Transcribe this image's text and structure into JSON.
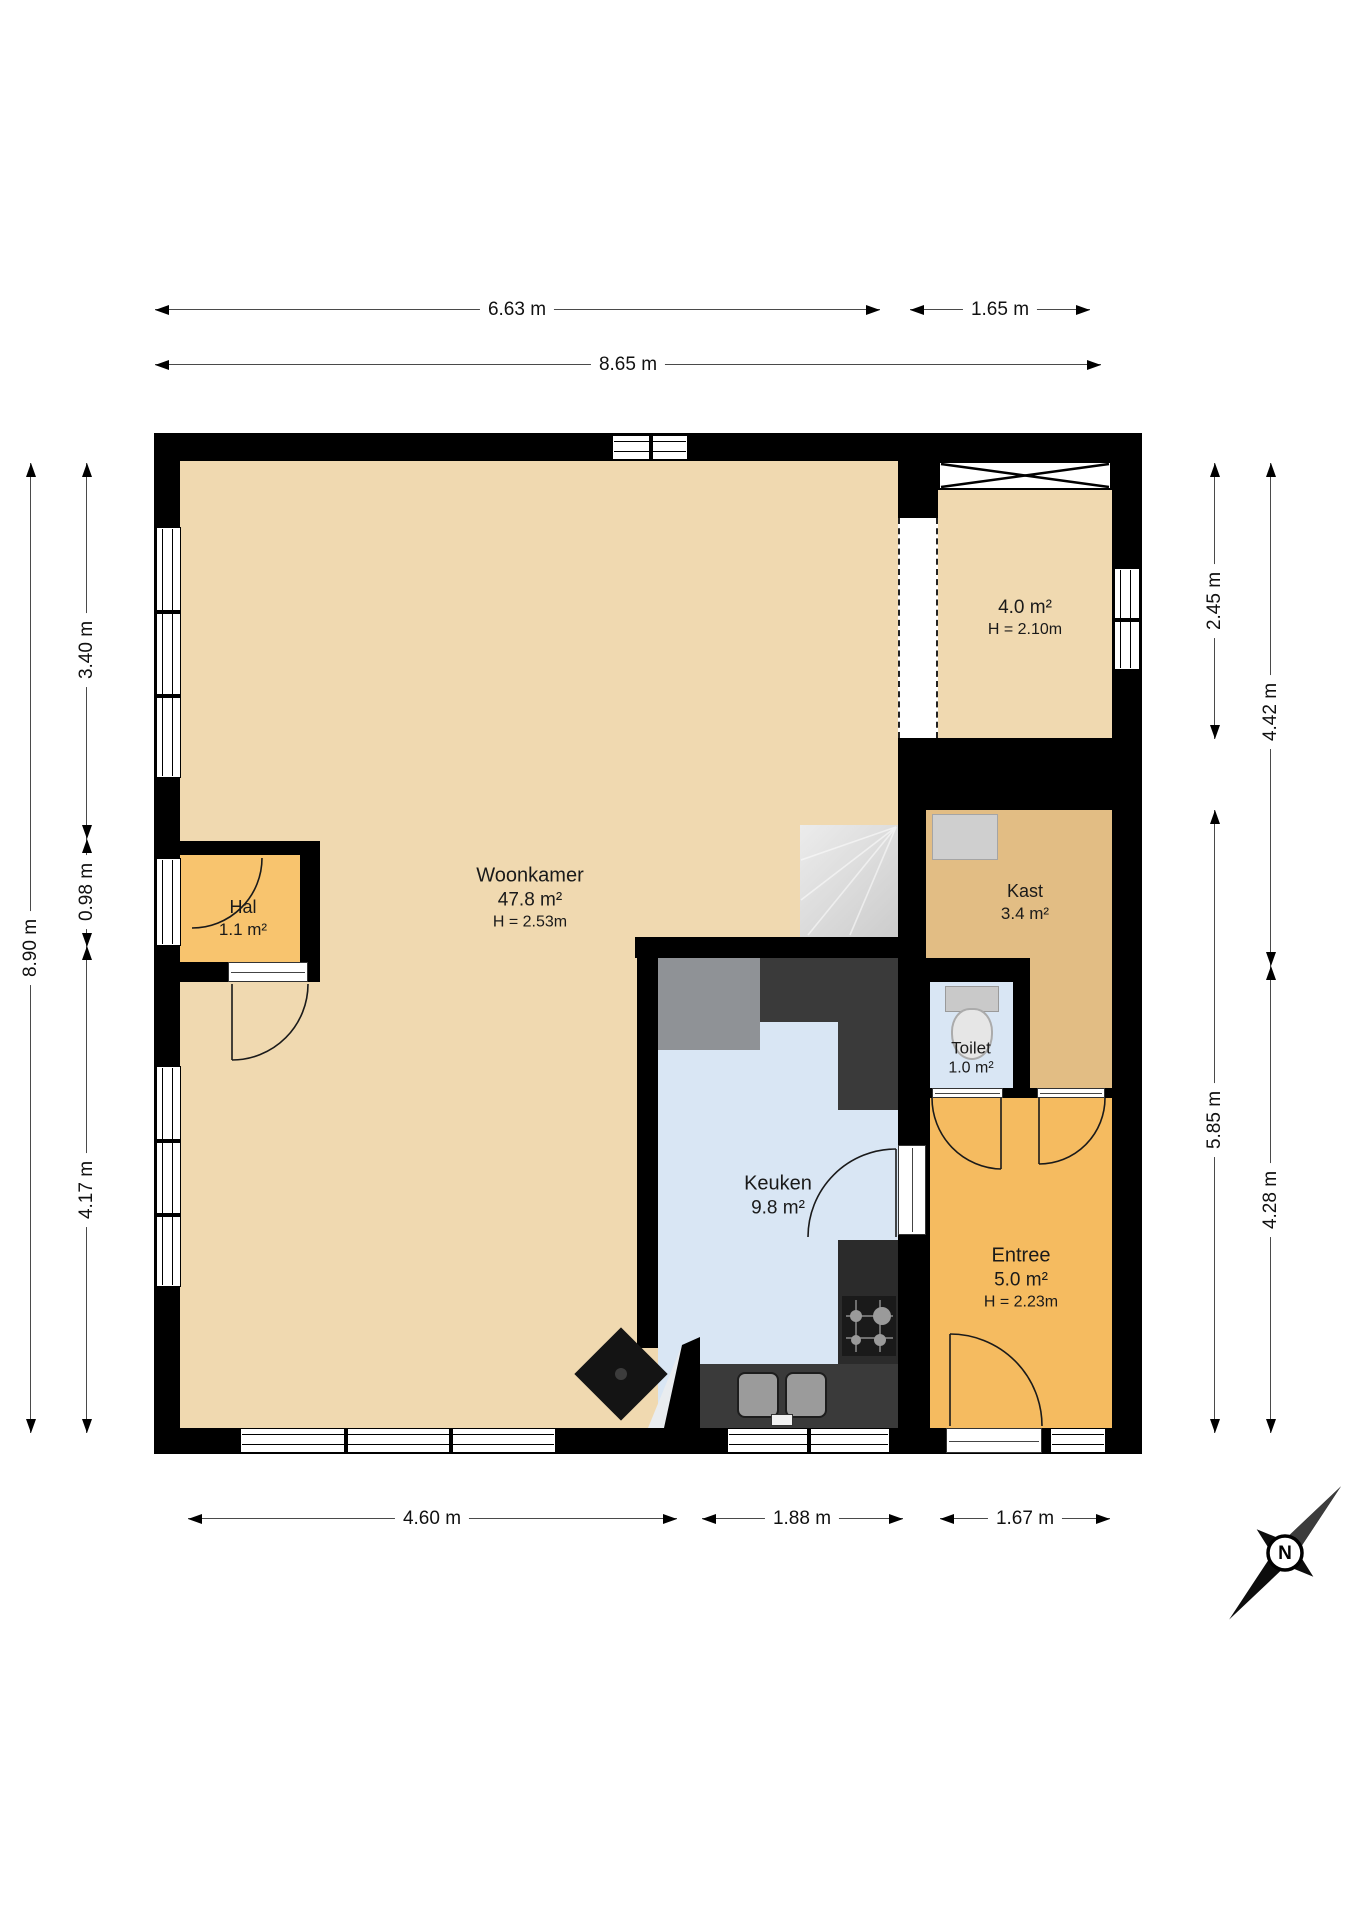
{
  "title": "Begane grond plattegrond",
  "rooms": {
    "woonkamer": {
      "name": "Woonkamer",
      "area": "47.8 m²",
      "ceiling": "H = 2.53m"
    },
    "hal": {
      "name": "Hal",
      "area": "1.1 m²"
    },
    "keuken": {
      "name": "Keuken",
      "area": "9.8 m²"
    },
    "kast": {
      "name": "Kast",
      "area": "3.4 m²"
    },
    "toilet": {
      "name": "Toilet",
      "area": "1.0 m²"
    },
    "entree": {
      "name": "Entree",
      "area": "5.0 m²",
      "ceiling": "H = 2.23m"
    },
    "storage": {
      "area": "4.0 m²",
      "ceiling": "H = 2.10m"
    }
  },
  "dimensions": {
    "top_width_left": "6.63 m",
    "top_width_right": "1.65 m",
    "top_width_total": "8.65 m",
    "left_height_total": "8.90 m",
    "left_seg_top": "3.40 m",
    "left_seg_mid": "0.98 m",
    "left_seg_bottom": "4.17 m",
    "right_inner_top": "2.45 m",
    "right_inner_bottom": "5.85 m",
    "right_outer_top": "4.42 m",
    "right_outer_bottom": "4.28 m",
    "bottom_left": "4.60 m",
    "bottom_mid": "1.88 m",
    "bottom_right": "1.67 m"
  },
  "compass": {
    "north_label": "N"
  },
  "colors": {
    "wall": "#000000",
    "floor_living": "#F0D9B0",
    "floor_hal": "#F8C46E",
    "floor_entree": "#F5BB60",
    "floor_kast": "#E2BD84",
    "floor_wet": "#D9E6F4",
    "counter_dark": "#3A3A3A",
    "counter_gray": "#8F9296",
    "stairs": "#DCDCDC"
  }
}
